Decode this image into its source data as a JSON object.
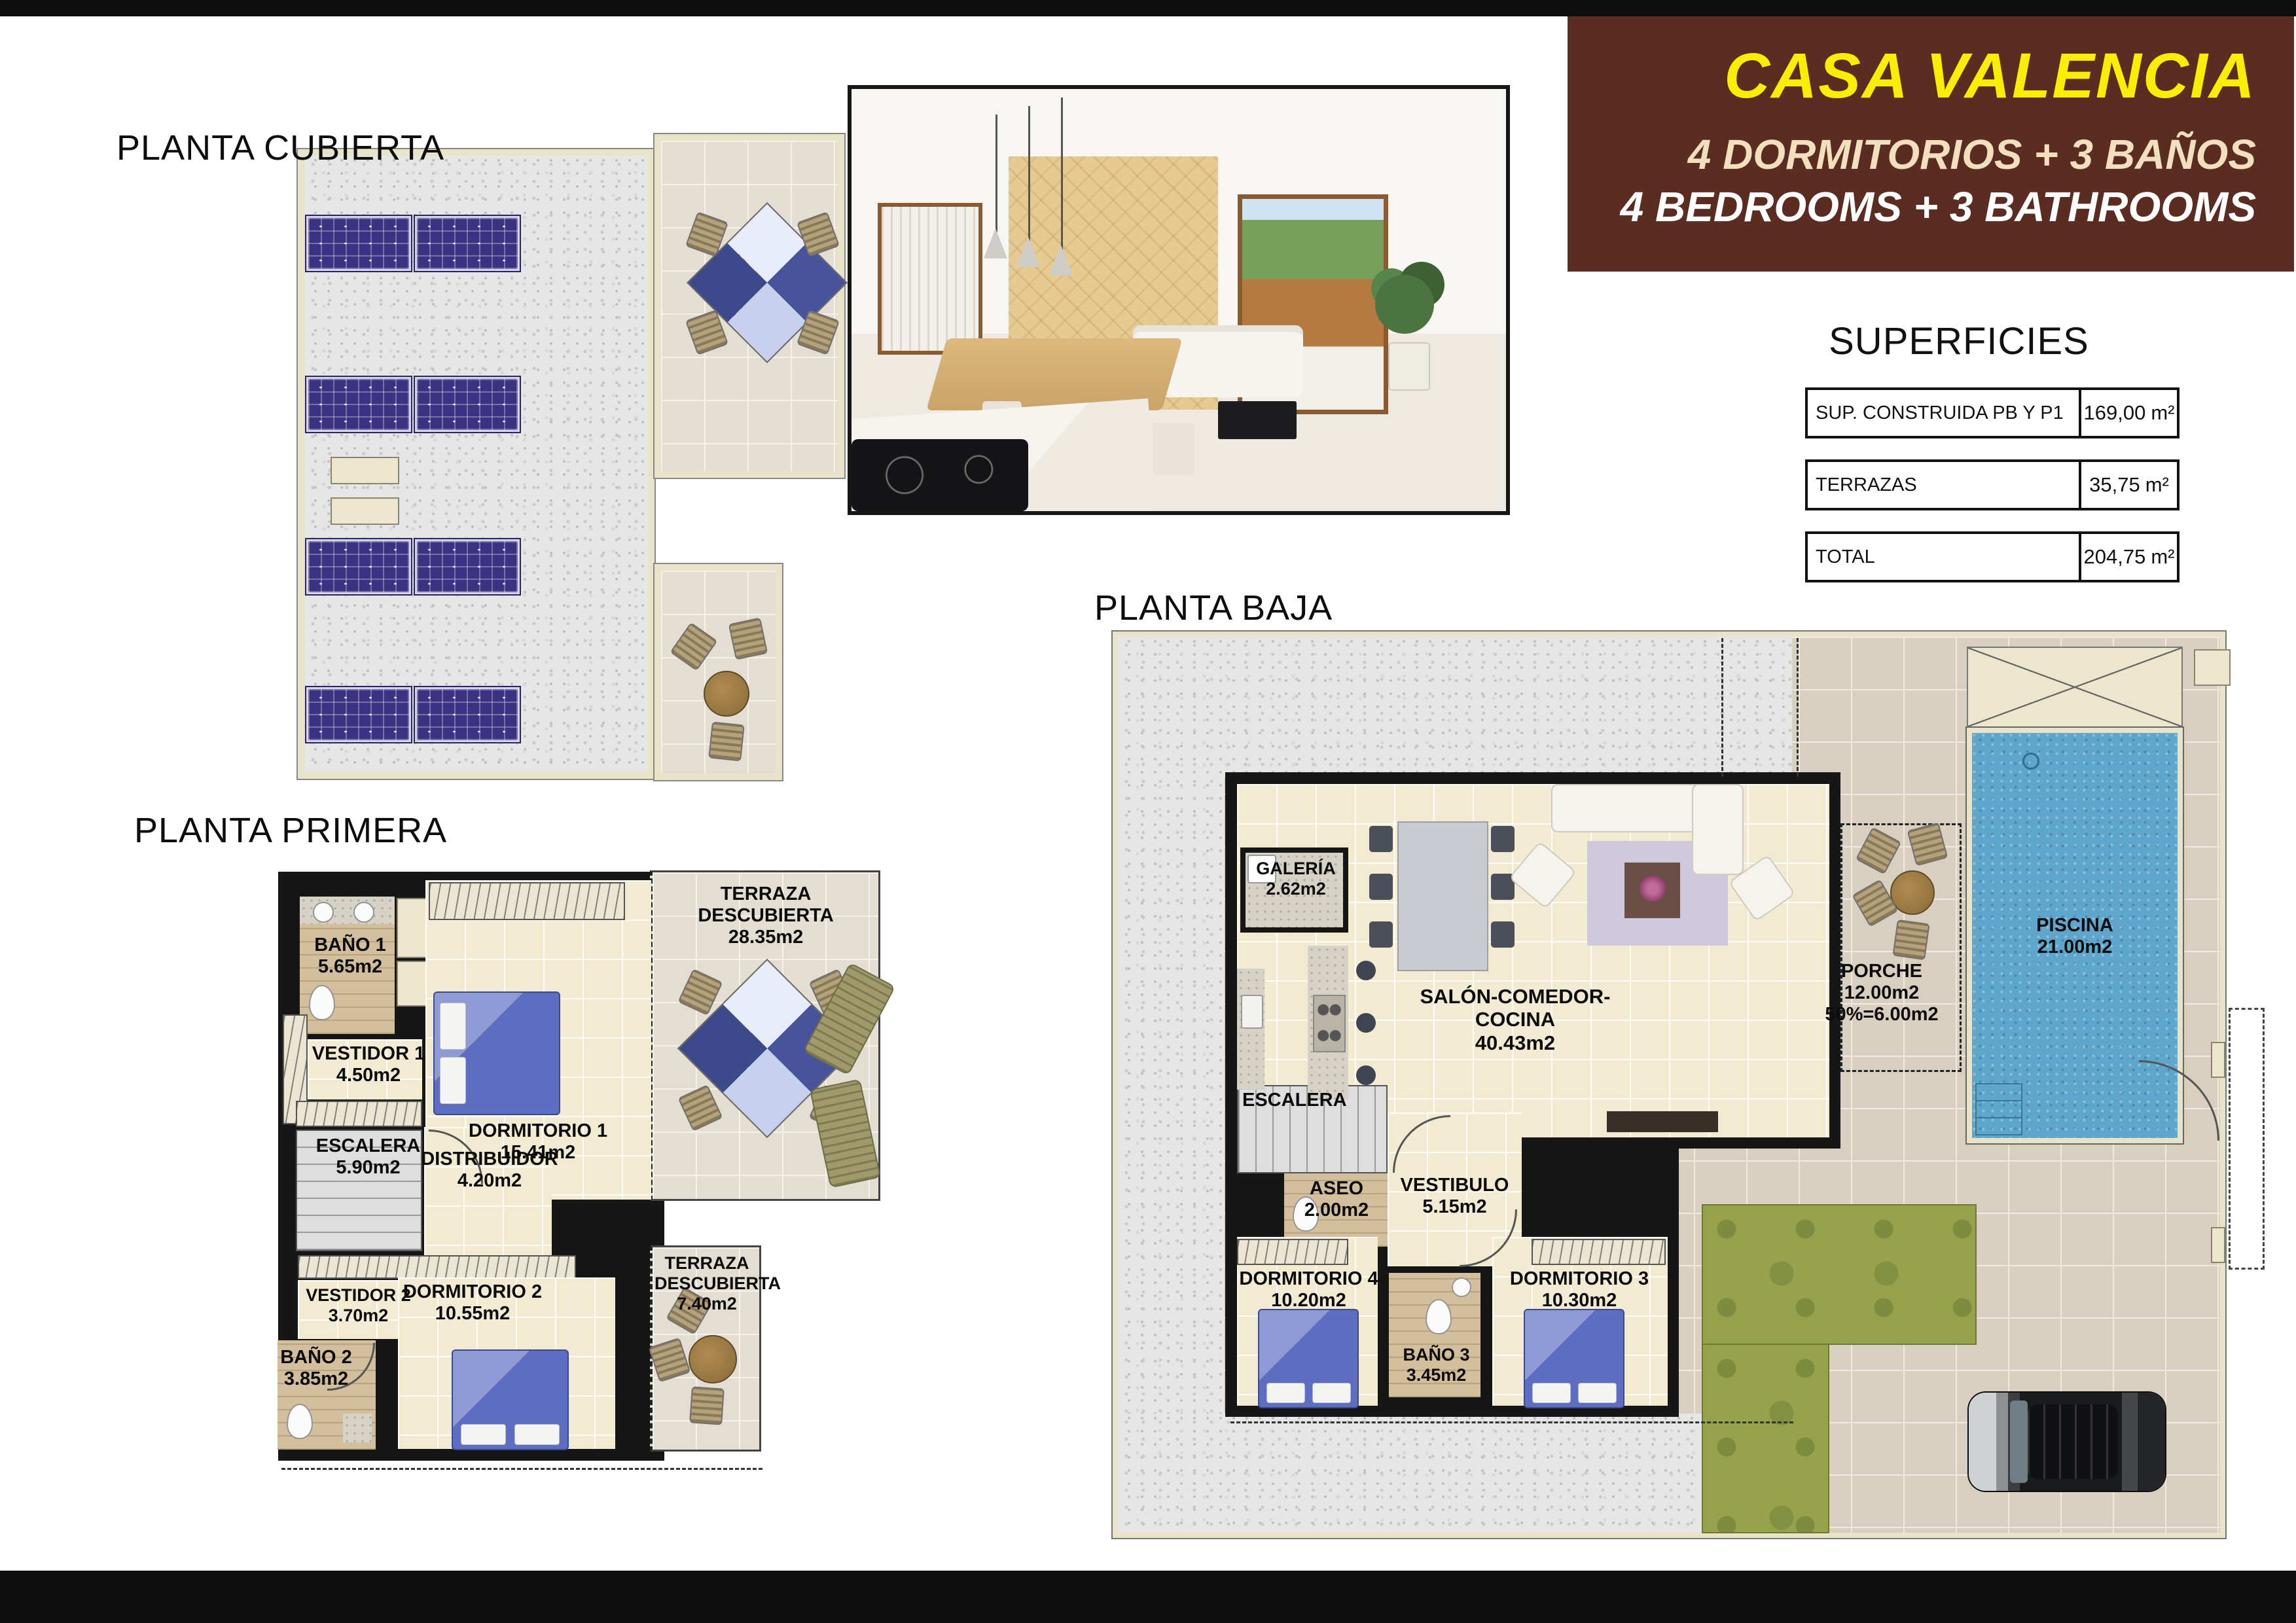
{
  "header": {
    "title": "CASA VALENCIA",
    "line_es": "4 DORMITORIOS + 3 BAÑOS",
    "line_en": "4 BEDROOMS + 3 BATHROOMS"
  },
  "superficies": {
    "title": "SUPERFICIES",
    "rows": [
      {
        "label": "SUP. CONSTRUIDA PB Y P1",
        "value": "169,00",
        "unit": "m²"
      },
      {
        "label": "TERRAZAS",
        "value": "35,75",
        "unit": "m²"
      },
      {
        "label": "TOTAL",
        "value": "204,75",
        "unit": "m²"
      }
    ]
  },
  "plans": {
    "cubierta": {
      "title": "PLANTA CUBIERTA"
    },
    "primera": {
      "title": "PLANTA PRIMERA",
      "rooms": {
        "bano1": {
          "name": "BAÑO 1",
          "area": "5.65m2"
        },
        "dormitorio1": {
          "name": "DORMITORIO 1",
          "area": "15.41m2"
        },
        "terraza1": {
          "name": "TERRAZA DESCUBIERTA",
          "area": "28.35m2"
        },
        "vestidor1": {
          "name": "VESTIDOR 1",
          "area": "4.50m2"
        },
        "escalera": {
          "name": "ESCALERA",
          "area": "5.90m2"
        },
        "distribuidor": {
          "name": "DISTRIBUIDOR",
          "area": "4.20m2"
        },
        "dormitorio2": {
          "name": "DORMITORIO 2",
          "area": "10.55m2"
        },
        "vestidor2": {
          "name": "VESTIDOR 2",
          "area": "3.70m2"
        },
        "bano2": {
          "name": "BAÑO 2",
          "area": "3.85m2"
        },
        "terraza2": {
          "name": "TERRAZA DESCUBIERTA",
          "area": "7.40m2"
        }
      }
    },
    "baja": {
      "title": "PLANTA BAJA",
      "rooms": {
        "galeria": {
          "name": "GALERÍA",
          "area": "2.62m2"
        },
        "salon": {
          "name": "SALÓN-COMEDOR-COCINA",
          "area": "40.43m2"
        },
        "porche": {
          "name": "PORCHE",
          "area": "12.00m2",
          "area2": "50%=6.00m2"
        },
        "piscina": {
          "name": "PISCINA",
          "area": "21.00m2"
        },
        "escalera": {
          "name": "ESCALERA"
        },
        "aseo": {
          "name": "ASEO",
          "area": "2.00m2"
        },
        "vestibulo": {
          "name": "VESTIBULO",
          "area": "5.15m2"
        },
        "dormitorio4": {
          "name": "DORMITORIO 4",
          "area": "10.20m2"
        },
        "dormitorio3": {
          "name": "DORMITORIO 3",
          "area": "10.30m2"
        },
        "bano3": {
          "name": "BAÑO 3",
          "area": "3.45m2"
        }
      }
    }
  },
  "colors": {
    "header_bg": "#5a2c22",
    "title_yellow": "#f8ee00",
    "subtitle_cream": "#f2dfbd",
    "subtitle_white": "#ffffff",
    "pool_blue": "#5fa6cc",
    "solar_panel": "#3b3282",
    "grass_green": "#97a24c",
    "wall_cream": "#ece6cc"
  }
}
